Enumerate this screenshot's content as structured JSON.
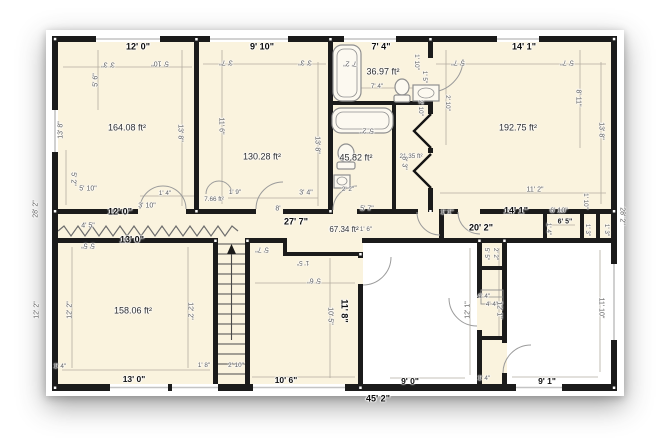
{
  "floor_plan": {
    "areas": {
      "room_top_left": "164.08 ft²",
      "room_top_middle": "130.28 ft²",
      "bathroom_top": "36.97 ft²",
      "bathroom_middle": "45.82 ft²",
      "closet_strip": "21.35 ft²",
      "room_top_right": "192.75 ft²",
      "hallway": "67.34 ft²",
      "hall_closet": "7.66 ft²",
      "room_bottom_left": "158.06 ft²"
    },
    "totals": {
      "overall_width": "45' 2\"",
      "overall_height_left": "28' 2\"",
      "overall_height_right": "28' 2\""
    },
    "bold_dims": {
      "top_room_a": "12' 0\"",
      "top_room_b": "9' 10\"",
      "top_bath": "7' 4\"",
      "top_room_f": "14' 1\"",
      "mid_room_a": "12' 0\"",
      "mid_room_g": "13' 0\"",
      "hall_length": "27' 7\"",
      "mid_room_f": "14' 1\"",
      "corridor_length": "20' 2\"",
      "room_h_right": "11' 8\""
    },
    "bottom_dims": {
      "room_g": "13' 0\"",
      "room_h": "10' 6\"",
      "white_left": "9' 0\"",
      "white_right": "9' 1\""
    },
    "small_dims": {
      "d01": "3' 3\"",
      "d02": "5' 10\"",
      "d03": "5' 6\"",
      "d04": "13' 8\"",
      "d05": "13' 8\"",
      "d06": "5' 10\"",
      "d07": "5' 2\"",
      "d08": "3' 7\"",
      "d09": "3' 3\"",
      "d10": "11' 6\"",
      "d11": "13' 8\"",
      "d12": "7' 2\"",
      "d13": "7' 4\"",
      "d14": "1' 10\"",
      "d15": "1' 5\"",
      "d16": "5' 2\"",
      "d17": "2' 2\"",
      "d18": "5' 7\"",
      "d19": "8' 3\"",
      "d20": "2' 10\"",
      "d21": "5' 7\"",
      "d22": "5' 7\"",
      "d23": "8' 11\"",
      "d24": "13' 8\"",
      "d25": "2' 10\"",
      "d26": "11' 2\"",
      "d27": "1' 10\"",
      "d28": "6' 10\"",
      "d29": "6' 5\"",
      "d30": "1' 3\"",
      "d31": "1' 3\"",
      "d32": "1' 4\"",
      "d33": "1' 4\"",
      "d34": "3' 10\"",
      "d35": "1' 9\"",
      "d36": "3' 4\"",
      "d37": "8'",
      "d38": "5' 7\"",
      "d39": "4' 5\"",
      "d40": "5' 5\"",
      "d41": "12' 2\"",
      "d42": "12' 2\"",
      "d43": "12' 2\"",
      "d44": "1' 4\"",
      "d45": "1' 8\"",
      "d46": "2' 10\"",
      "d47": "5' 6\"",
      "d48": "10' 5\"",
      "d49": "1' 5\"",
      "d50": "5' 5\"",
      "d51": "2' 2\"",
      "d52": "4' 4\"",
      "d53": "4' 4\"",
      "d54": "1' 4\"",
      "d55": "12' 1\"",
      "d56": "12' 1\"",
      "d57": "11' 10\"",
      "d58": "1' 6\"",
      "d59": "1' 1\""
    },
    "colors": {
      "room_fill": "#FAF3DE",
      "wall": "#1B1B1B",
      "window": "#C4C4C4",
      "dim_text": "#5D5D5D",
      "bold_text": "#0C0C0C"
    },
    "icons": {
      "stairs_arrow": "up-arrow"
    }
  }
}
